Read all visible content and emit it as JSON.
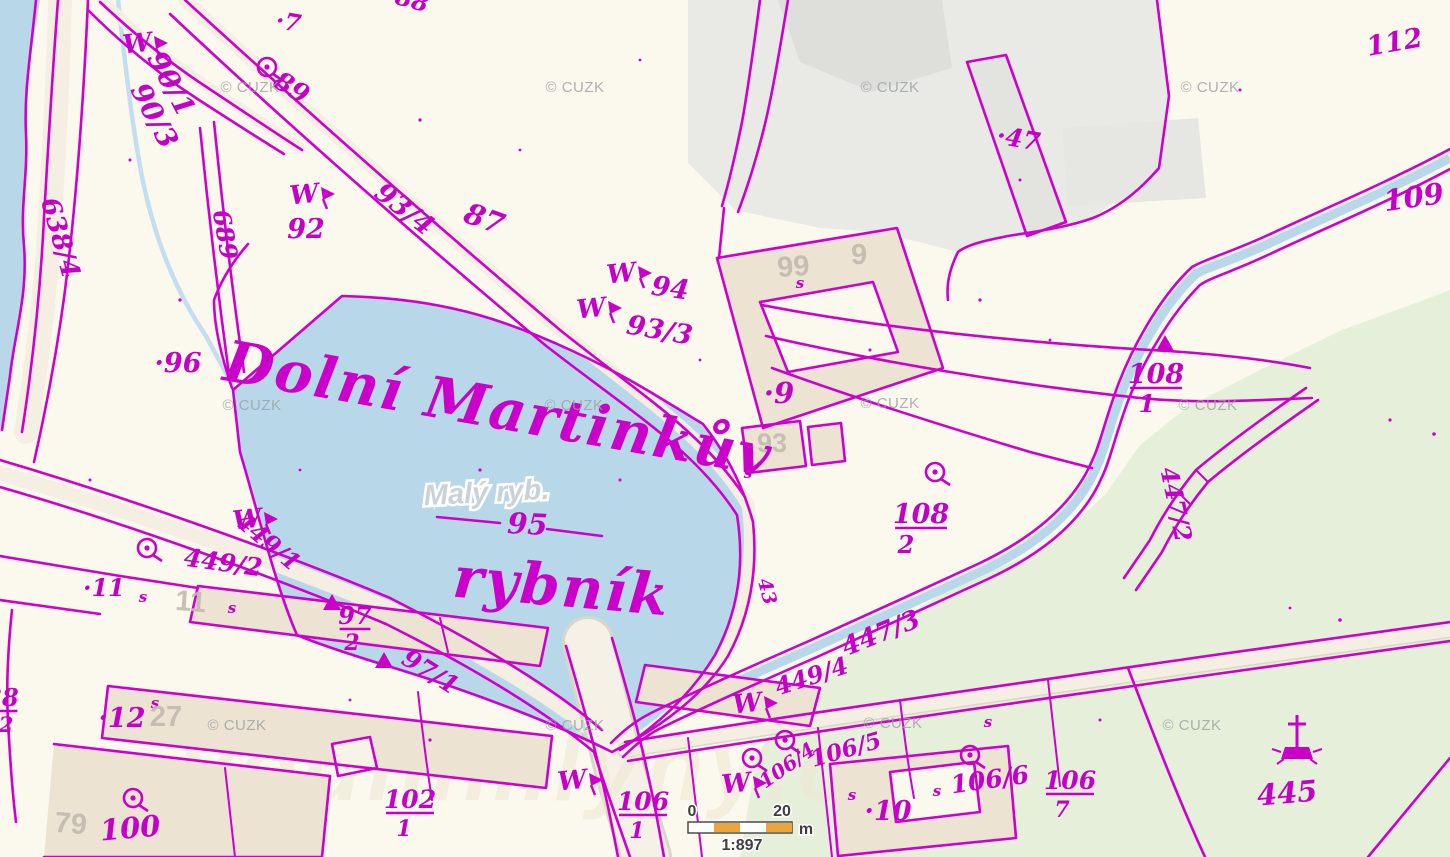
{
  "copyright": {
    "text": "© CUZK",
    "positions": [
      {
        "x": 250,
        "y": 92
      },
      {
        "x": 575,
        "y": 92
      },
      {
        "x": 890,
        "y": 92
      },
      {
        "x": 1210,
        "y": 92
      },
      {
        "x": 252,
        "y": 410
      },
      {
        "x": 574,
        "y": 410
      },
      {
        "x": 890,
        "y": 408
      },
      {
        "x": 1208,
        "y": 410
      },
      {
        "x": 237,
        "y": 730
      },
      {
        "x": 575,
        "y": 730
      },
      {
        "x": 893,
        "y": 728
      },
      {
        "x": 1192,
        "y": 730
      }
    ]
  },
  "site_watermark": "vodnimlyny.cz",
  "scalebar": {
    "start": "0",
    "end": "20",
    "unit": "m",
    "ratio": "1:897"
  },
  "colors": {
    "line": "#cd00cd",
    "label": "#c400c8",
    "water": "#b8d8e9",
    "green": "#e6efda",
    "building": "#ece3d2",
    "urban": "#e9e9e6",
    "road": "#f4efe2",
    "scale_orange": "#eaa63c",
    "base_label": "#c2bab0"
  },
  "labels": [
    {
      "t": "·7",
      "x": 287,
      "y": 30,
      "s": 24,
      "r": 10,
      "c": "p"
    },
    {
      "t": "88",
      "x": 410,
      "y": 8,
      "s": 24,
      "r": 15,
      "c": "p"
    },
    {
      "t": "89",
      "x": 287,
      "y": 95,
      "s": 26,
      "r": 32,
      "c": "p"
    },
    {
      "t": "90/1",
      "x": 163,
      "y": 88,
      "s": 28,
      "r": 62,
      "c": "p"
    },
    {
      "t": "90/3",
      "x": 146,
      "y": 120,
      "s": 28,
      "r": 62,
      "c": "p"
    },
    {
      "t": "638/4",
      "x": 52,
      "y": 240,
      "s": 26,
      "r": 74,
      "c": "p"
    },
    {
      "t": "689",
      "x": 217,
      "y": 236,
      "s": 24,
      "r": 80,
      "c": "p"
    },
    {
      "t": "92",
      "x": 306,
      "y": 238,
      "s": 27,
      "r": 0,
      "c": "p"
    },
    {
      "t": "93/4",
      "x": 399,
      "y": 216,
      "s": 27,
      "r": 38,
      "c": "p"
    },
    {
      "t": "87",
      "x": 481,
      "y": 228,
      "s": 29,
      "r": 20,
      "c": "p"
    },
    {
      "t": "94",
      "x": 669,
      "y": 297,
      "s": 27,
      "r": 8,
      "c": "p"
    },
    {
      "t": "93/3",
      "x": 658,
      "y": 339,
      "s": 27,
      "r": 10,
      "c": "p"
    },
    {
      "t": "·96",
      "x": 178,
      "y": 372,
      "s": 27,
      "r": 0,
      "c": "p"
    },
    {
      "t": "·47",
      "x": 1017,
      "y": 147,
      "s": 25,
      "r": 10,
      "c": "p"
    },
    {
      "t": "112",
      "x": 1396,
      "y": 51,
      "s": 27,
      "r": -10,
      "c": "p"
    },
    {
      "t": "109",
      "x": 1415,
      "y": 207,
      "s": 29,
      "r": -8,
      "c": "p"
    },
    {
      "t": "108",
      "x": 1156,
      "y": 383,
      "s": 27,
      "r": 0,
      "c": "p",
      "u": 1
    },
    {
      "t": "1",
      "x": 1147,
      "y": 412,
      "s": 24,
      "r": 0,
      "c": "p"
    },
    {
      "t": "447/2",
      "x": 1168,
      "y": 506,
      "s": 24,
      "r": 78,
      "c": "p"
    },
    {
      "t": "108",
      "x": 921,
      "y": 523,
      "s": 27,
      "r": 0,
      "c": "p",
      "u": 1
    },
    {
      "t": "2",
      "x": 906,
      "y": 553,
      "s": 24,
      "r": 0,
      "c": "p"
    },
    {
      "t": "·9",
      "x": 779,
      "y": 403,
      "s": 29,
      "r": 0,
      "c": "p"
    },
    {
      "t": "447/3",
      "x": 884,
      "y": 641,
      "s": 26,
      "r": -22,
      "c": "p"
    },
    {
      "t": "449/4",
      "x": 814,
      "y": 684,
      "s": 24,
      "r": -18,
      "c": "p"
    },
    {
      "t": "449/1",
      "x": 263,
      "y": 548,
      "s": 24,
      "r": 40,
      "c": "p"
    },
    {
      "t": "449/2",
      "x": 222,
      "y": 571,
      "s": 25,
      "r": 8,
      "c": "p"
    },
    {
      "t": "·11",
      "x": 104,
      "y": 596,
      "s": 24,
      "r": 0,
      "c": "p"
    },
    {
      "t": "97",
      "x": 355,
      "y": 624,
      "s": 24,
      "r": 0,
      "c": "p",
      "u": 1
    },
    {
      "t": "2",
      "x": 352,
      "y": 650,
      "s": 22,
      "r": 0,
      "c": "p"
    },
    {
      "t": "97/1",
      "x": 426,
      "y": 679,
      "s": 25,
      "r": 32,
      "c": "p"
    },
    {
      "t": "·12",
      "x": 122,
      "y": 727,
      "s": 27,
      "r": 0,
      "c": "p"
    },
    {
      "t": "100",
      "x": 131,
      "y": 838,
      "s": 29,
      "r": -5,
      "c": "p"
    },
    {
      "t": "102",
      "x": 410,
      "y": 808,
      "s": 25,
      "r": 0,
      "c": "p",
      "u": 1
    },
    {
      "t": "1",
      "x": 404,
      "y": 836,
      "s": 22,
      "r": 0,
      "c": "p"
    },
    {
      "t": "106",
      "x": 643,
      "y": 810,
      "s": 25,
      "r": 0,
      "c": "p",
      "u": 1
    },
    {
      "t": "1",
      "x": 637,
      "y": 838,
      "s": 22,
      "r": 0,
      "c": "p"
    },
    {
      "t": "·10",
      "x": 888,
      "y": 820,
      "s": 27,
      "r": 0,
      "c": "p"
    },
    {
      "t": "106/5",
      "x": 848,
      "y": 757,
      "s": 23,
      "r": -16,
      "c": "p"
    },
    {
      "t": "106/6",
      "x": 991,
      "y": 788,
      "s": 25,
      "r": -8,
      "c": "p"
    },
    {
      "t": "106",
      "x": 1070,
      "y": 789,
      "s": 25,
      "r": 0,
      "c": "p",
      "u": 1
    },
    {
      "t": "7",
      "x": 1062,
      "y": 817,
      "s": 22,
      "r": 0,
      "c": "p"
    },
    {
      "t": "445",
      "x": 1288,
      "y": 803,
      "s": 29,
      "r": -5,
      "c": "p"
    },
    {
      "t": "106/4",
      "x": 791,
      "y": 771,
      "s": 20,
      "r": -35,
      "c": "p"
    },
    {
      "t": "43",
      "x": 761,
      "y": 593,
      "s": 19,
      "r": 75,
      "c": "p"
    },
    {
      "t": "95",
      "x": 527,
      "y": 534,
      "s": 29,
      "r": 3,
      "c": "p"
    },
    {
      "t": "38",
      "x": 2,
      "y": 706,
      "s": 24,
      "r": 0,
      "c": "p",
      "u": 1
    },
    {
      "t": "2",
      "x": 6,
      "y": 732,
      "s": 21,
      "r": 0,
      "c": "p"
    },
    {
      "t": "99",
      "x": 794,
      "y": 276,
      "s": 29,
      "r": -4,
      "c": "b"
    },
    {
      "t": "9",
      "x": 859,
      "y": 264,
      "s": 29,
      "r": 0,
      "c": "b"
    },
    {
      "t": "93",
      "x": 772,
      "y": 452,
      "s": 27,
      "r": 0,
      "c": "b"
    },
    {
      "t": "11",
      "x": 190,
      "y": 611,
      "s": 29,
      "r": 4,
      "c": "b"
    },
    {
      "t": "27",
      "x": 166,
      "y": 726,
      "s": 29,
      "r": 0,
      "c": "b"
    },
    {
      "t": "79",
      "x": 70,
      "y": 833,
      "s": 29,
      "r": 5,
      "c": "b"
    },
    {
      "t": "Dolní Martinkův",
      "x": 495,
      "y": 428,
      "s": 57,
      "r": 10,
      "c": "pn"
    },
    {
      "t": "rybník",
      "x": 560,
      "y": 606,
      "s": 57,
      "r": 5,
      "c": "pn"
    },
    {
      "t": "Malý ryb.",
      "x": 487,
      "y": 502,
      "s": 29,
      "r": -3,
      "c": "wn"
    }
  ],
  "symbols": [
    {
      "type": "well",
      "x": 267,
      "y": 67
    },
    {
      "type": "well",
      "x": 147,
      "y": 548
    },
    {
      "type": "well",
      "x": 133,
      "y": 798
    },
    {
      "type": "well",
      "x": 935,
      "y": 472
    },
    {
      "type": "well",
      "x": 970,
      "y": 755
    },
    {
      "type": "well",
      "x": 752,
      "y": 758
    },
    {
      "type": "well",
      "x": 785,
      "y": 740
    },
    {
      "type": "meadow",
      "x": 138,
      "y": 52
    },
    {
      "type": "meadow",
      "x": 305,
      "y": 203
    },
    {
      "type": "meadow",
      "x": 622,
      "y": 282
    },
    {
      "type": "meadow",
      "x": 592,
      "y": 317
    },
    {
      "type": "meadow",
      "x": 248,
      "y": 528
    },
    {
      "type": "meadow",
      "x": 573,
      "y": 789
    },
    {
      "type": "meadow",
      "x": 737,
      "y": 792
    },
    {
      "type": "meadow",
      "x": 748,
      "y": 712
    },
    {
      "type": "triangle",
      "x": 332,
      "y": 603
    },
    {
      "type": "triangle",
      "x": 384,
      "y": 661
    },
    {
      "type": "triangle",
      "x": 1165,
      "y": 344
    },
    {
      "type": "cross",
      "x": 1297,
      "y": 745
    },
    {
      "type": "s-mark",
      "x": 800,
      "y": 288
    },
    {
      "type": "s-mark",
      "x": 748,
      "y": 478
    },
    {
      "type": "s-mark",
      "x": 852,
      "y": 800
    },
    {
      "type": "s-mark",
      "x": 937,
      "y": 796
    },
    {
      "type": "s-mark",
      "x": 988,
      "y": 727
    },
    {
      "type": "s-mark",
      "x": 143,
      "y": 602
    },
    {
      "type": "s-mark",
      "x": 232,
      "y": 613
    },
    {
      "type": "s-mark",
      "x": 155,
      "y": 708
    }
  ]
}
